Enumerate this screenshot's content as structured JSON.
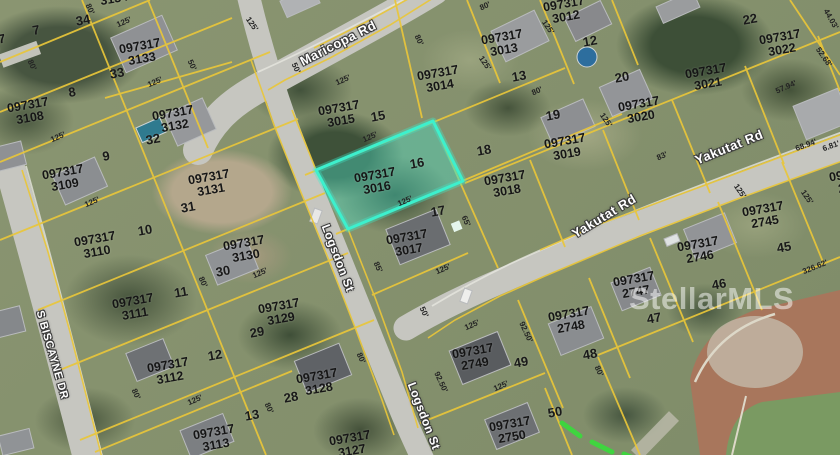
{
  "map": {
    "watermark": "StellarMLS",
    "highlight": {
      "parcel_id": "097317 3016",
      "lot": "16",
      "polygon": "316,170 433,121 463,181 348,229",
      "fill": "#48d8c2",
      "border": "#3df0cd"
    },
    "colors": {
      "parcel_line": "#e9c63a",
      "road": "#c6c6c0",
      "label": "#161616",
      "street_label": "#ffffff",
      "survey_dash": "#3fd43f"
    }
  },
  "streets": [
    {
      "name": "Maricopa Rd",
      "x": 338,
      "y": 43,
      "rot": -27,
      "size": 13
    },
    {
      "name": "Logsdon St",
      "x": 338,
      "y": 258,
      "rot": 69,
      "size": 12
    },
    {
      "name": "Logsdon St",
      "x": 424,
      "y": 416,
      "rot": 69,
      "size": 12
    },
    {
      "name": "Yakutat Rd",
      "x": 729,
      "y": 147,
      "rot": -22,
      "size": 13
    },
    {
      "name": "Yakutat Rd",
      "x": 604,
      "y": 216,
      "rot": -31,
      "size": 13
    },
    {
      "name": "S BISCAYNE DR",
      "x": 52,
      "y": 355,
      "rot": 74,
      "size": 11
    }
  ],
  "parcels": [
    {
      "p": "097317",
      "n": "3134",
      "x": 113,
      "y": -7
    },
    {
      "p": "097317",
      "n": "3107",
      "x": -14,
      "y": 49
    },
    {
      "p": "097317",
      "n": "3133",
      "x": 141,
      "y": 53
    },
    {
      "p": "097317",
      "n": "3108",
      "x": 29,
      "y": 112
    },
    {
      "p": "097317",
      "n": "3132",
      "x": 174,
      "y": 120
    },
    {
      "p": "097317",
      "n": "3015",
      "x": 340,
      "y": 115
    },
    {
      "p": "097317",
      "n": "3014",
      "x": 439,
      "y": 80
    },
    {
      "p": "097317",
      "n": "3012",
      "x": 565,
      "y": 11
    },
    {
      "p": "097317",
      "n": "3013",
      "x": 503,
      "y": 44
    },
    {
      "p": "097317",
      "n": "3022",
      "x": 781,
      "y": 44
    },
    {
      "p": "097317",
      "n": "3021",
      "x": 707,
      "y": 78
    },
    {
      "p": "097317",
      "n": "3020",
      "x": 640,
      "y": 111
    },
    {
      "p": "097317",
      "n": "3019",
      "x": 566,
      "y": 148
    },
    {
      "p": "097317",
      "n": "3018",
      "x": 506,
      "y": 185
    },
    {
      "p": "097317",
      "n": "3016",
      "x": 376,
      "y": 182,
      "hl": true
    },
    {
      "p": "097317",
      "n": "3017",
      "x": 408,
      "y": 244
    },
    {
      "p": "097317",
      "n": "3109",
      "x": 64,
      "y": 179
    },
    {
      "p": "097317",
      "n": "3131",
      "x": 210,
      "y": 184
    },
    {
      "p": "097317",
      "n": "3110",
      "x": 96,
      "y": 246
    },
    {
      "p": "097317",
      "n": "3130",
      "x": 245,
      "y": 250
    },
    {
      "p": "097317",
      "n": "3111",
      "x": 134,
      "y": 308
    },
    {
      "p": "097317",
      "n": "3129",
      "x": 280,
      "y": 313
    },
    {
      "p": "097317",
      "n": "3112",
      "x": 169,
      "y": 372
    },
    {
      "p": "097317",
      "n": "3128",
      "x": 318,
      "y": 383
    },
    {
      "p": "097317",
      "n": "3113",
      "x": 215,
      "y": 439
    },
    {
      "p": "097317",
      "n": "3127",
      "x": 351,
      "y": 445
    },
    {
      "p": "097317",
      "n": "2744",
      "x": 851,
      "y": 181
    },
    {
      "p": "097317",
      "n": "2745",
      "x": 764,
      "y": 216
    },
    {
      "p": "097317",
      "n": "2746",
      "x": 699,
      "y": 251
    },
    {
      "p": "097317",
      "n": "2747",
      "x": 635,
      "y": 286
    },
    {
      "p": "097317",
      "n": "2748",
      "x": 570,
      "y": 321
    },
    {
      "p": "097317",
      "n": "2749",
      "x": 474,
      "y": 358
    },
    {
      "p": "097317",
      "n": "2750",
      "x": 511,
      "y": 431
    }
  ],
  "lot_numbers": [
    {
      "n": "34",
      "x": 83,
      "y": 20
    },
    {
      "n": "7",
      "x": 36,
      "y": 30
    },
    {
      "n": "33",
      "x": 117,
      "y": 73
    },
    {
      "n": "8",
      "x": 72,
      "y": 92
    },
    {
      "n": "32",
      "x": 153,
      "y": 139
    },
    {
      "n": "9",
      "x": 106,
      "y": 156
    },
    {
      "n": "15",
      "x": 378,
      "y": 116
    },
    {
      "n": "16",
      "x": 417,
      "y": 163
    },
    {
      "n": "31",
      "x": 188,
      "y": 207
    },
    {
      "n": "10",
      "x": 145,
      "y": 230
    },
    {
      "n": "30",
      "x": 223,
      "y": 271
    },
    {
      "n": "11",
      "x": 181,
      "y": 292
    },
    {
      "n": "29",
      "x": 257,
      "y": 332
    },
    {
      "n": "12",
      "x": 215,
      "y": 355
    },
    {
      "n": "28",
      "x": 291,
      "y": 397
    },
    {
      "n": "13",
      "x": 252,
      "y": 415
    },
    {
      "n": "17",
      "x": 438,
      "y": 211
    },
    {
      "n": "18",
      "x": 484,
      "y": 150
    },
    {
      "n": "19",
      "x": 553,
      "y": 115
    },
    {
      "n": "20",
      "x": 622,
      "y": 77
    },
    {
      "n": "12",
      "x": 590,
      "y": 41
    },
    {
      "n": "13",
      "x": 519,
      "y": 76
    },
    {
      "n": "22",
      "x": 750,
      "y": 19
    },
    {
      "n": "45",
      "x": 784,
      "y": 247
    },
    {
      "n": "46",
      "x": 719,
      "y": 284
    },
    {
      "n": "47",
      "x": 654,
      "y": 318
    },
    {
      "n": "48",
      "x": 590,
      "y": 354
    },
    {
      "n": "49",
      "x": 521,
      "y": 362
    },
    {
      "n": "50",
      "x": 555,
      "y": 412
    }
  ],
  "measurements": [
    {
      "t": "80'",
      "x": 90,
      "y": 9,
      "r": 65
    },
    {
      "t": "125'",
      "x": 124,
      "y": 22,
      "r": -24
    },
    {
      "t": "80'",
      "x": 32,
      "y": 65,
      "r": 65
    },
    {
      "t": "50'",
      "x": 192,
      "y": 65,
      "r": 65
    },
    {
      "t": "125'",
      "x": 155,
      "y": 82,
      "r": -24
    },
    {
      "t": "125'",
      "x": 58,
      "y": 137,
      "r": -24
    },
    {
      "t": "125'",
      "x": 92,
      "y": 202,
      "r": -24
    },
    {
      "t": "80'",
      "x": 203,
      "y": 282,
      "r": 65
    },
    {
      "t": "125'",
      "x": 260,
      "y": 273,
      "r": -24
    },
    {
      "t": "80'",
      "x": 136,
      "y": 394,
      "r": 65
    },
    {
      "t": "125'",
      "x": 195,
      "y": 400,
      "r": -24
    },
    {
      "t": "80'",
      "x": 269,
      "y": 408,
      "r": 65
    },
    {
      "t": "80'",
      "x": 361,
      "y": 358,
      "r": 65
    },
    {
      "t": "125'",
      "x": 343,
      "y": 80,
      "r": -24
    },
    {
      "t": "50'",
      "x": 296,
      "y": 68,
      "r": 65
    },
    {
      "t": "80'",
      "x": 419,
      "y": 40,
      "r": 65
    },
    {
      "t": "125'",
      "x": 370,
      "y": 137,
      "r": -24
    },
    {
      "t": "125'",
      "x": 405,
      "y": 201,
      "r": -24
    },
    {
      "t": "65'",
      "x": 466,
      "y": 221,
      "r": 65
    },
    {
      "t": "85'",
      "x": 378,
      "y": 267,
      "r": 65
    },
    {
      "t": "125'",
      "x": 443,
      "y": 269,
      "r": -24
    },
    {
      "t": "50'",
      "x": 424,
      "y": 312,
      "r": 65
    },
    {
      "t": "125'",
      "x": 472,
      "y": 325,
      "r": -24
    },
    {
      "t": "92.50'",
      "x": 526,
      "y": 332,
      "r": 65
    },
    {
      "t": "92.50'",
      "x": 441,
      "y": 382,
      "r": 65
    },
    {
      "t": "125'",
      "x": 501,
      "y": 386,
      "r": -24
    },
    {
      "t": "80'",
      "x": 599,
      "y": 371,
      "r": 65
    },
    {
      "t": "80'",
      "x": 485,
      "y": 6,
      "r": -24
    },
    {
      "t": "125'",
      "x": 485,
      "y": 63,
      "r": 55
    },
    {
      "t": "80'",
      "x": 537,
      "y": 91,
      "r": -24
    },
    {
      "t": "125'",
      "x": 548,
      "y": 27,
      "r": 55
    },
    {
      "t": "125'",
      "x": 606,
      "y": 120,
      "r": 55
    },
    {
      "t": "83'",
      "x": 662,
      "y": 156,
      "r": -24
    },
    {
      "t": "44.03'",
      "x": 831,
      "y": 19,
      "r": 60
    },
    {
      "t": "52.68'",
      "x": 824,
      "y": 57,
      "r": 55
    },
    {
      "t": "57.94'",
      "x": 786,
      "y": 87,
      "r": -24
    },
    {
      "t": "68.94'",
      "x": 806,
      "y": 145,
      "r": -20
    },
    {
      "t": "6.81'",
      "x": 831,
      "y": 146,
      "r": -20
    },
    {
      "t": "125'",
      "x": 740,
      "y": 191,
      "r": 55
    },
    {
      "t": "125'",
      "x": 807,
      "y": 197,
      "r": 55
    },
    {
      "t": "326.62'",
      "x": 815,
      "y": 267,
      "r": -22
    },
    {
      "t": "125'",
      "x": 252,
      "y": 24,
      "r": 55
    }
  ]
}
